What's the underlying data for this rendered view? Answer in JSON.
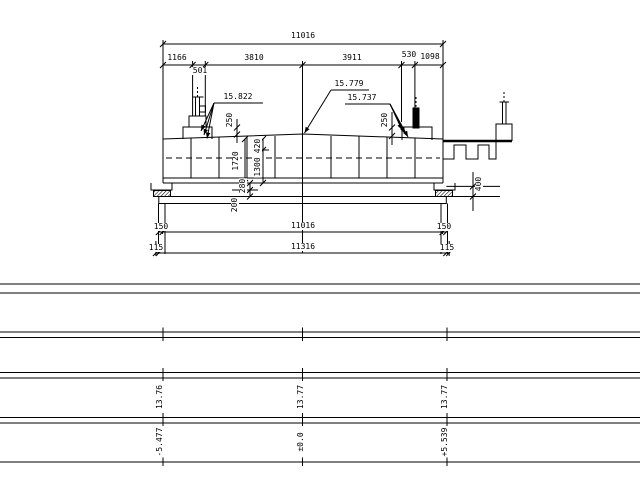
{
  "drawing": {
    "top_dimensions": {
      "overall": "11016",
      "segments": [
        "1166",
        "3810",
        "3911",
        "530",
        "1098"
      ],
      "sub_segment": "501"
    },
    "elevation_labels": {
      "left": "15.822",
      "center": "15.779",
      "right": "15.737"
    },
    "curb_dims": {
      "left": "250",
      "right": "250"
    },
    "depth_dims": {
      "total": "1720",
      "slab": "420",
      "web": "1300",
      "plinth": "280",
      "bearing": "200"
    },
    "cap_dim": "400",
    "bottom_dimensions": {
      "row1": {
        "side": "150",
        "center": "11016"
      },
      "row2": {
        "side": "115",
        "center": "11316"
      }
    },
    "profile_stations": {
      "levels": [
        "13.76",
        "13.77",
        "13.77"
      ],
      "offsets": [
        "-5.477",
        "±0.0",
        "+5.539"
      ]
    },
    "line_color": "#000000"
  }
}
